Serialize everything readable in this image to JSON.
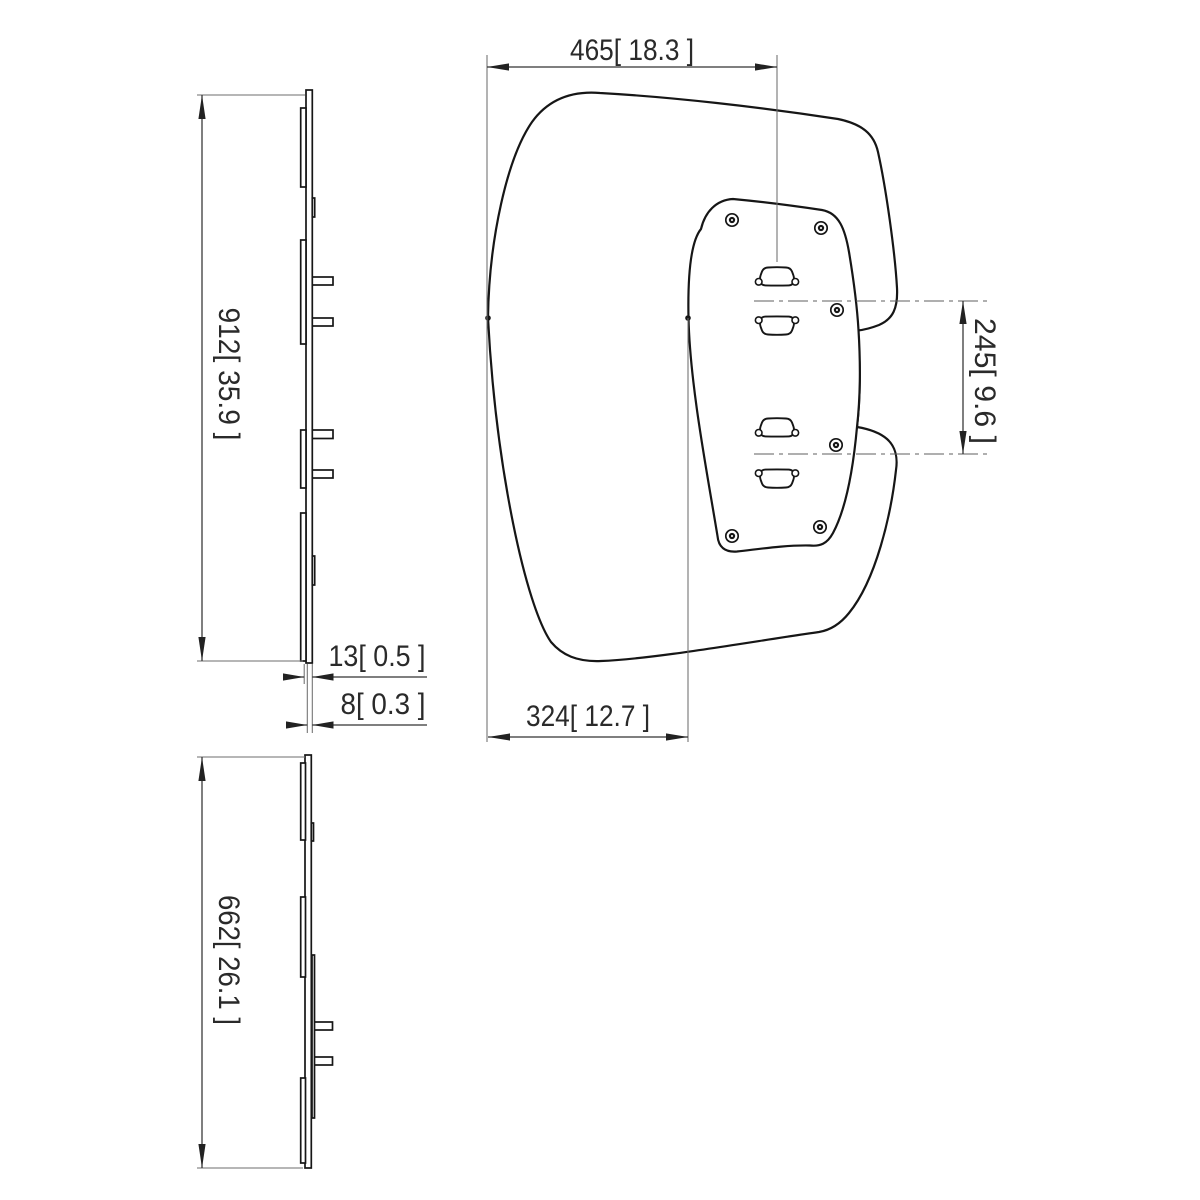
{
  "drawing": {
    "kind": "technical dimension drawing, three orthographic views of a display mounting panel",
    "units_format": "mm [inch]"
  },
  "colors": {
    "background": "#ffffff",
    "object_line": "#161616",
    "dim_line": "#333333",
    "ext_line": "#6e6e6e",
    "text": "#2a2a2a"
  },
  "dimensions": {
    "width_left_edge_to_slot_center": {
      "label": "465[ 18.3 ]",
      "mm": "465",
      "inch": "18.3"
    },
    "slot_pitch_vertical": {
      "label": "245[ 9.6 ]",
      "mm": "245",
      "inch": "9.6"
    },
    "width_left_edge_to_plate_edge": {
      "label": "324[ 12.7 ]",
      "mm": "324",
      "inch": "12.7"
    },
    "panel_height": {
      "label": "912[ 35.9 ]",
      "mm": "912",
      "inch": "35.9"
    },
    "thickness_total": {
      "label": "13[ 0.5 ]",
      "mm": "13",
      "inch": "0.5"
    },
    "thickness_plate": {
      "label": "8[ 0.3 ]",
      "mm": "8",
      "inch": "0.3"
    },
    "panel_width": {
      "label": "662[ 26.1 ]",
      "mm": "662",
      "inch": "26.1"
    }
  }
}
